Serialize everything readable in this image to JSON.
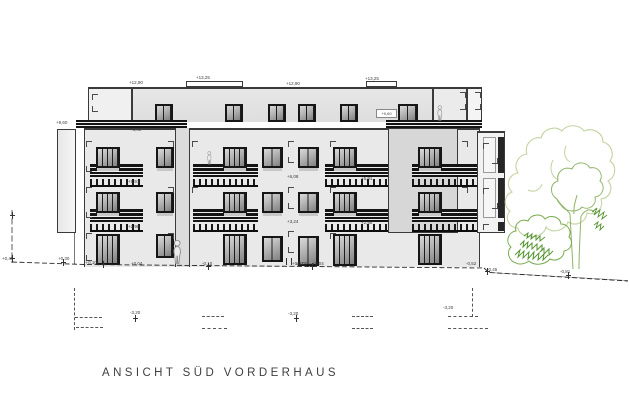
{
  "title": "ANSICHT SÜD VORDERHAUS",
  "palette": {
    "ink": "#1a1a1a",
    "annotation": "#3c3c3c",
    "tree_light": "#c3d3a0",
    "tree_mid": "#8fb466",
    "bush_outline": "#79ab4e",
    "bush_fill": "#569431"
  },
  "blocks": [
    {
      "name": "attic-left",
      "x": 88,
      "y": 87,
      "w": 44,
      "h": 35,
      "fill": "#f0f0f0",
      "bt": 2,
      "nb": true
    },
    {
      "name": "attic-mid",
      "x": 132,
      "y": 87,
      "w": 301,
      "h": 35,
      "fill": "linear-gradient(180deg,#e7e7e7,#dedede)",
      "bt": 2,
      "nb": true
    },
    {
      "name": "attic-right",
      "x": 433,
      "y": 87,
      "w": 34,
      "h": 35,
      "fill": "#ebebeb",
      "bt": 2,
      "nb": true
    },
    {
      "name": "attic-far-right",
      "x": 467,
      "y": 87,
      "w": 15,
      "h": 35,
      "fill": "#f4f4f4",
      "bt": 2,
      "nb": true
    },
    {
      "name": "roof-box-1",
      "x": 186,
      "y": 81,
      "w": 57,
      "h": 6,
      "fill": "#ffffff"
    },
    {
      "name": "roof-box-2",
      "x": 366,
      "y": 81,
      "w": 31,
      "h": 6,
      "fill": "#ffffff"
    },
    {
      "name": "main-facade",
      "x": 84,
      "y": 128,
      "w": 396,
      "h": 139,
      "fill": "#e9e9e9",
      "bt": 2,
      "nb": true
    },
    {
      "name": "stair-strip",
      "x": 175,
      "y": 128,
      "w": 15,
      "h": 139,
      "fill": "#dcdcdc",
      "sides": "lr"
    },
    {
      "name": "right-panel",
      "x": 388,
      "y": 128,
      "w": 70,
      "h": 105,
      "fill": "#d7d7d7"
    },
    {
      "name": "left-wing",
      "x": 57,
      "y": 129,
      "w": 19,
      "h": 104,
      "fill": "linear-gradient(90deg,#e7e7e7,#f6f6f6)"
    },
    {
      "name": "left-wing-pier",
      "x": 74,
      "y": 233,
      "w": 1,
      "h": 31,
      "fill": "#777777",
      "sides": "none"
    },
    {
      "name": "right-wing",
      "x": 477,
      "y": 131,
      "w": 28,
      "h": 102,
      "fill": "#f2f2f2",
      "bt": 2
    }
  ],
  "terrace_railings": [
    {
      "x": 76,
      "y": 120,
      "w": 111
    },
    {
      "x": 386,
      "y": 120,
      "w": 96
    }
  ],
  "balconies": [
    {
      "x": 90,
      "y": 164,
      "w": 53
    },
    {
      "x": 90,
      "y": 209,
      "w": 53
    },
    {
      "x": 193,
      "y": 164,
      "w": 65
    },
    {
      "x": 193,
      "y": 209,
      "w": 65
    },
    {
      "x": 325,
      "y": 164,
      "w": 63
    },
    {
      "x": 325,
      "y": 209,
      "w": 63
    },
    {
      "x": 412,
      "y": 164,
      "w": 65
    },
    {
      "x": 412,
      "y": 209,
      "w": 65
    }
  ],
  "windows": [
    {
      "x": 155,
      "y": 104,
      "w": 18,
      "h": 18,
      "p": 2
    },
    {
      "x": 225,
      "y": 104,
      "w": 18,
      "h": 18,
      "p": 2
    },
    {
      "x": 268,
      "y": 104,
      "w": 18,
      "h": 18,
      "p": 2
    },
    {
      "x": 298,
      "y": 104,
      "w": 18,
      "h": 18,
      "p": 2
    },
    {
      "x": 340,
      "y": 104,
      "w": 18,
      "h": 18,
      "p": 2
    },
    {
      "x": 398,
      "y": 104,
      "w": 20,
      "h": 18,
      "p": 2
    },
    {
      "x": 96,
      "y": 147,
      "w": 24,
      "h": 21,
      "p": 4,
      "s": 1
    },
    {
      "x": 156,
      "y": 147,
      "w": 18,
      "h": 21,
      "p": 2,
      "s": 1
    },
    {
      "x": 223,
      "y": 147,
      "w": 24,
      "h": 21,
      "p": 4,
      "s": 1
    },
    {
      "x": 262,
      "y": 147,
      "w": 21,
      "h": 21,
      "p": 2,
      "s": 1
    },
    {
      "x": 298,
      "y": 147,
      "w": 21,
      "h": 21,
      "p": 2,
      "s": 1
    },
    {
      "x": 333,
      "y": 147,
      "w": 24,
      "h": 21,
      "p": 4,
      "s": 1
    },
    {
      "x": 418,
      "y": 147,
      "w": 24,
      "h": 21,
      "p": 4,
      "s": 1
    },
    {
      "x": 96,
      "y": 192,
      "w": 24,
      "h": 21,
      "p": 4,
      "s": 1
    },
    {
      "x": 156,
      "y": 192,
      "w": 18,
      "h": 21,
      "p": 2,
      "s": 1
    },
    {
      "x": 223,
      "y": 192,
      "w": 24,
      "h": 21,
      "p": 4,
      "s": 1
    },
    {
      "x": 262,
      "y": 192,
      "w": 21,
      "h": 21,
      "p": 2,
      "s": 1
    },
    {
      "x": 298,
      "y": 192,
      "w": 21,
      "h": 21,
      "p": 2,
      "s": 1
    },
    {
      "x": 333,
      "y": 192,
      "w": 24,
      "h": 21,
      "p": 4,
      "s": 1
    },
    {
      "x": 418,
      "y": 192,
      "w": 24,
      "h": 21,
      "p": 4,
      "s": 1
    },
    {
      "x": 96,
      "y": 234,
      "w": 24,
      "h": 31,
      "p": 4
    },
    {
      "x": 156,
      "y": 234,
      "w": 18,
      "h": 24,
      "p": 2
    },
    {
      "x": 223,
      "y": 234,
      "w": 24,
      "h": 31,
      "p": 4
    },
    {
      "x": 262,
      "y": 236,
      "w": 21,
      "h": 26,
      "p": 2
    },
    {
      "x": 298,
      "y": 236,
      "w": 21,
      "h": 30,
      "p": 2
    },
    {
      "x": 333,
      "y": 234,
      "w": 24,
      "h": 32,
      "p": 4
    },
    {
      "x": 418,
      "y": 234,
      "w": 24,
      "h": 31,
      "p": 4
    }
  ],
  "wing_rows": [
    {
      "y": 137,
      "h": 36,
      "frame": true
    },
    {
      "y": 178,
      "h": 40,
      "frame": true
    },
    {
      "y": 222,
      "h": 9,
      "frame": false
    }
  ],
  "wall_plate": {
    "x": 376,
    "y": 109,
    "w": 21,
    "h": 9,
    "text": "+9,60"
  },
  "labels": [
    {
      "t": "+12,90",
      "x": 129,
      "y": 80
    },
    {
      "t": "+13,25",
      "x": 196,
      "y": 75
    },
    {
      "t": "+12,90",
      "x": 286,
      "y": 81
    },
    {
      "t": "+13,25",
      "x": 365,
      "y": 76
    },
    {
      "t": "+9,60",
      "x": 56,
      "y": 120
    },
    {
      "t": "+8,80",
      "x": 130,
      "y": 127
    },
    {
      "t": "+5,91",
      "x": 128,
      "y": 179
    },
    {
      "t": "+2,98",
      "x": 128,
      "y": 224
    },
    {
      "t": "+5,91",
      "x": 361,
      "y": 176
    },
    {
      "t": "+2,98",
      "x": 361,
      "y": 220
    },
    {
      "t": "+6,08",
      "x": 287,
      "y": 174
    },
    {
      "t": "+3,24",
      "x": 287,
      "y": 219
    },
    {
      "t": "±0,00 = +0,04",
      "x": 296,
      "y": 261
    },
    {
      "t": "+0,45",
      "x": 2,
      "y": 256
    },
    {
      "t": "+0,30",
      "x": 58,
      "y": 256
    },
    {
      "t": "(+0,10)",
      "x": 84,
      "y": 260
    },
    {
      "t": "+0,04",
      "x": 131,
      "y": 261
    },
    {
      "t": "-0,10",
      "x": 202,
      "y": 261
    },
    {
      "t": "+0,02",
      "x": 292,
      "y": 261
    },
    {
      "t": "-0,52",
      "x": 466,
      "y": 261
    },
    {
      "t": "-0,45",
      "x": 487,
      "y": 267
    },
    {
      "t": "-0,81",
      "x": 560,
      "y": 269
    },
    {
      "t": "-3,20",
      "x": 130,
      "y": 310
    },
    {
      "t": "-3,20",
      "x": 288,
      "y": 311
    },
    {
      "t": "-3,20",
      "x": 443,
      "y": 305
    }
  ],
  "marks": [
    {
      "x": 92,
      "y": 94,
      "t": "tl"
    },
    {
      "x": 92,
      "y": 106,
      "t": "bl"
    },
    {
      "x": 460,
      "y": 92,
      "t": "tr"
    },
    {
      "x": 460,
      "y": 104,
      "t": "br"
    },
    {
      "x": 475,
      "y": 92,
      "t": "tr"
    },
    {
      "x": 475,
      "y": 104,
      "t": "br"
    },
    {
      "x": 86,
      "y": 141,
      "t": "tl"
    },
    {
      "x": 86,
      "y": 166,
      "t": "bl"
    },
    {
      "x": 86,
      "y": 187,
      "t": "tl"
    },
    {
      "x": 86,
      "y": 212,
      "t": "bl"
    },
    {
      "x": 86,
      "y": 233,
      "t": "tl"
    },
    {
      "x": 86,
      "y": 255,
      "t": "bl"
    },
    {
      "x": 168,
      "y": 141,
      "t": "tr"
    },
    {
      "x": 192,
      "y": 141,
      "t": "tl"
    },
    {
      "x": 168,
      "y": 187,
      "t": "tr"
    },
    {
      "x": 192,
      "y": 187,
      "t": "tl"
    },
    {
      "x": 168,
      "y": 233,
      "t": "tr"
    },
    {
      "x": 288,
      "y": 141,
      "t": "tl"
    },
    {
      "x": 288,
      "y": 157,
      "t": "bl"
    },
    {
      "x": 288,
      "y": 187,
      "t": "tl"
    },
    {
      "x": 288,
      "y": 203,
      "t": "bl"
    },
    {
      "x": 288,
      "y": 231,
      "t": "tl"
    },
    {
      "x": 288,
      "y": 247,
      "t": "bl"
    },
    {
      "x": 330,
      "y": 141,
      "t": "tl"
    },
    {
      "x": 330,
      "y": 187,
      "t": "tl"
    },
    {
      "x": 330,
      "y": 233,
      "t": "tl"
    },
    {
      "x": 462,
      "y": 141,
      "t": "tr"
    },
    {
      "x": 462,
      "y": 187,
      "t": "tr"
    },
    {
      "x": 483,
      "y": 143,
      "t": "tl"
    },
    {
      "x": 492,
      "y": 158,
      "t": "br"
    },
    {
      "x": 483,
      "y": 188,
      "t": "tl"
    },
    {
      "x": 492,
      "y": 203,
      "t": "br"
    },
    {
      "x": 483,
      "y": 224,
      "t": "tl"
    }
  ],
  "basement_dashes": [
    {
      "o": "v",
      "x": 74,
      "y": 288,
      "l": 42
    },
    {
      "o": "h",
      "x": 75,
      "y": 317,
      "l": 27
    },
    {
      "o": "h",
      "x": 76,
      "y": 327,
      "l": 27
    },
    {
      "o": "h",
      "x": 202,
      "y": 316,
      "l": 22
    },
    {
      "o": "h",
      "x": 202,
      "y": 328,
      "l": 25
    },
    {
      "o": "h",
      "x": 352,
      "y": 316,
      "l": 21
    },
    {
      "o": "h",
      "x": 352,
      "y": 328,
      "l": 21
    },
    {
      "o": "v",
      "x": 472,
      "y": 288,
      "l": 29
    },
    {
      "o": "h",
      "x": 448,
      "y": 316,
      "l": 30
    },
    {
      "o": "h",
      "x": 448,
      "y": 328,
      "l": 40
    }
  ],
  "ticks": [
    {
      "x": 63,
      "y": 259,
      "t": "cross"
    },
    {
      "x": 103,
      "y": 261,
      "t": "cross"
    },
    {
      "x": 208,
      "y": 263,
      "t": "cross"
    },
    {
      "x": 312,
      "y": 263,
      "t": "cross"
    },
    {
      "x": 487,
      "y": 268,
      "t": "cross"
    },
    {
      "x": 568,
      "y": 272,
      "t": "cross"
    },
    {
      "x": 135,
      "y": 315,
      "t": "cross"
    },
    {
      "x": 296,
      "y": 315,
      "t": "cross"
    },
    {
      "x": 12,
      "y": 212,
      "t": "cross"
    },
    {
      "x": 12,
      "y": 255,
      "t": "cross"
    },
    {
      "x": 286,
      "y": 258,
      "t": "bar"
    },
    {
      "x": 291,
      "y": 258,
      "t": "bar"
    }
  ],
  "persons": [
    {
      "x": 172,
      "y": 240,
      "scale": 1.04
    },
    {
      "x": 206.5,
      "y": 151.5,
      "scale": 0.56
    },
    {
      "x": 436.5,
      "y": 105.5,
      "scale": 0.66
    }
  ]
}
